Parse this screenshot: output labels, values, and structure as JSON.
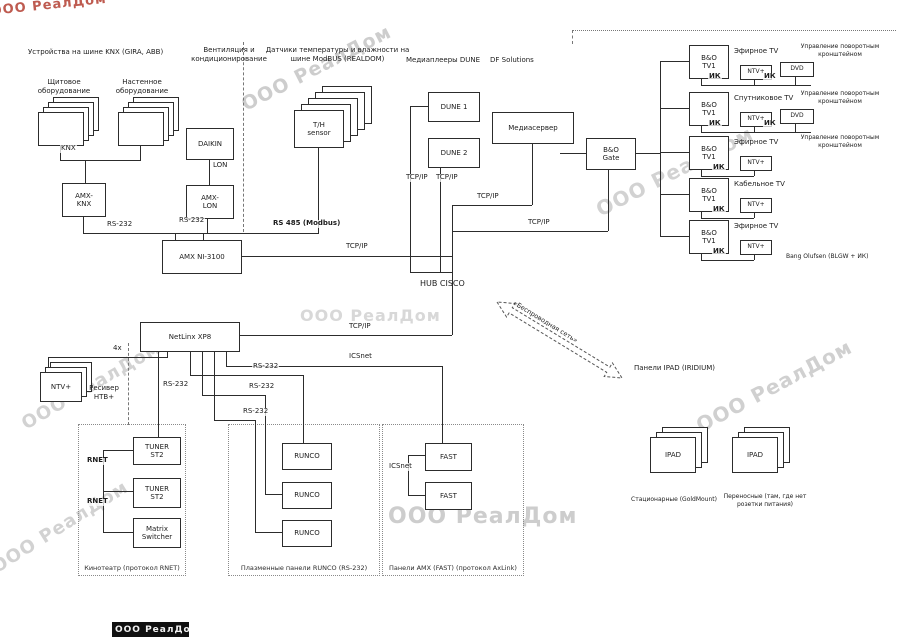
{
  "watermark_text": "ООО РеалДом",
  "footer": {
    "text": "ООО РеалДом"
  },
  "wireless": {
    "label": "«Беспроводная сеть»"
  },
  "diagram": {
    "separators": [
      {
        "x": 243,
        "y": 42,
        "h": 190,
        "kind": "v"
      },
      {
        "x": 128,
        "y": 343,
        "h": 82,
        "kind": "v"
      },
      {
        "x": 572,
        "y": 30,
        "w": 324,
        "kind": "h"
      },
      {
        "x": 572,
        "y": 30,
        "h": 14,
        "kind": "v"
      }
    ],
    "watermarks": [
      {
        "x": -10,
        "y": 4,
        "s": 13,
        "r": -6,
        "c": "#b84a3e",
        "o": 0.9
      },
      {
        "x": 238,
        "y": 96,
        "s": 19,
        "r": -27,
        "c": "#cdcdcd",
        "o": 1
      },
      {
        "x": 592,
        "y": 200,
        "s": 20,
        "r": -27,
        "c": "#d2d2d2",
        "o": 1
      },
      {
        "x": 300,
        "y": 306,
        "s": 16,
        "r": 0,
        "c": "#d8d8d8",
        "o": 1
      },
      {
        "x": 18,
        "y": 416,
        "s": 18,
        "r": -30,
        "c": "#d2d2d2",
        "o": 1
      },
      {
        "x": 692,
        "y": 416,
        "s": 20,
        "r": -28,
        "c": "#d0d0d0",
        "o": 1
      },
      {
        "x": 388,
        "y": 504,
        "s": 22,
        "r": 0,
        "c": "#cdcdcd",
        "o": 1
      },
      {
        "x": -12,
        "y": 560,
        "s": 18,
        "r": -32,
        "c": "#d2d2d2",
        "o": 1
      }
    ],
    "regions": [
      {
        "id": "cinema-zone",
        "x": 78,
        "y": 424,
        "w": 106,
        "h": 150,
        "cap": "Кинотеатр (протокол RNET)"
      },
      {
        "id": "runco-zone",
        "x": 228,
        "y": 424,
        "w": 150,
        "h": 150,
        "cap": "Плазменные панели RUNCO (RS-232)"
      },
      {
        "id": "fast-zone",
        "x": 382,
        "y": 424,
        "w": 140,
        "h": 150,
        "cap": "Панели AMX (FAST) (протокол AxLink)"
      }
    ],
    "stacks": [
      {
        "id": "knx-stack-shield",
        "x": 38,
        "y": 112,
        "w": 44,
        "h": 32,
        "n": 4,
        "dx": 5,
        "dy": -5,
        "t": ""
      },
      {
        "id": "knx-stack-wall",
        "x": 118,
        "y": 112,
        "w": 44,
        "h": 32,
        "n": 4,
        "dx": 5,
        "dy": -5,
        "t": ""
      },
      {
        "id": "th-sensor-stack",
        "x": 294,
        "y": 110,
        "w": 48,
        "h": 36,
        "n": 5,
        "dx": 7,
        "dy": -6,
        "t": "T/H\nsensor"
      },
      {
        "id": "ntv-receiver-stack",
        "x": 40,
        "y": 372,
        "w": 40,
        "h": 28,
        "n": 3,
        "dx": 5,
        "dy": -5,
        "t": "NTV+"
      },
      {
        "id": "ipad-stack-stationary",
        "x": 650,
        "y": 437,
        "w": 44,
        "h": 34,
        "n": 3,
        "dx": 6,
        "dy": -5,
        "t": "IPAD"
      },
      {
        "id": "ipad-stack-portable",
        "x": 732,
        "y": 437,
        "w": 44,
        "h": 34,
        "n": 3,
        "dx": 6,
        "dy": -5,
        "t": "IPAD"
      }
    ],
    "boxes": [
      {
        "id": "amx-knx",
        "x": 62,
        "y": 183,
        "w": 42,
        "h": 32,
        "t": "AMX-\nKNX"
      },
      {
        "id": "daikin",
        "x": 186,
        "y": 128,
        "w": 46,
        "h": 30,
        "t": "DAIKIN"
      },
      {
        "id": "amx-lon",
        "x": 186,
        "y": 185,
        "w": 46,
        "h": 32,
        "t": "AMX-\nLON"
      },
      {
        "id": "amx-ni-3100",
        "x": 162,
        "y": 240,
        "w": 78,
        "h": 32,
        "t": "AMX NI-3100"
      },
      {
        "id": "dune-1",
        "x": 428,
        "y": 92,
        "w": 50,
        "h": 28,
        "t": "DUNE 1"
      },
      {
        "id": "dune-2",
        "x": 428,
        "y": 138,
        "w": 50,
        "h": 28,
        "t": "DUNE 2"
      },
      {
        "id": "media-server",
        "x": 492,
        "y": 112,
        "w": 80,
        "h": 30,
        "t": "Медиасервер"
      },
      {
        "id": "bo-gate",
        "x": 586,
        "y": 138,
        "w": 48,
        "h": 30,
        "t": "B&O\nGate"
      },
      {
        "id": "netlinx-xp8",
        "x": 140,
        "y": 322,
        "w": 98,
        "h": 28,
        "t": "NetLinx XP8"
      },
      {
        "id": "bo-tv-1",
        "x": 689,
        "y": 45,
        "w": 38,
        "h": 32,
        "t": "B&O\nTV1"
      },
      {
        "id": "bo-tv-2",
        "x": 689,
        "y": 92,
        "w": 38,
        "h": 32,
        "t": "B&O\nTV1"
      },
      {
        "id": "bo-tv-3",
        "x": 689,
        "y": 136,
        "w": 38,
        "h": 32,
        "t": "B&O\nTV1"
      },
      {
        "id": "bo-tv-4",
        "x": 689,
        "y": 178,
        "w": 38,
        "h": 32,
        "t": "B&O\nTV1"
      },
      {
        "id": "bo-tv-5",
        "x": 689,
        "y": 220,
        "w": 38,
        "h": 32,
        "t": "B&O\nTV1"
      },
      {
        "id": "ntv-row1",
        "x": 740,
        "y": 65,
        "w": 30,
        "h": 13,
        "t": "NTV+",
        "s": 6
      },
      {
        "id": "dvd-row1",
        "x": 780,
        "y": 62,
        "w": 32,
        "h": 13,
        "t": "DVD",
        "s": 6
      },
      {
        "id": "ntv-row2",
        "x": 740,
        "y": 112,
        "w": 30,
        "h": 13,
        "t": "NTV+",
        "s": 6
      },
      {
        "id": "dvd-row2",
        "x": 780,
        "y": 109,
        "w": 32,
        "h": 13,
        "t": "DVD",
        "s": 6
      },
      {
        "id": "ntv-row3",
        "x": 740,
        "y": 156,
        "w": 30,
        "h": 13,
        "t": "NTV+",
        "s": 6
      },
      {
        "id": "ntv-row4",
        "x": 740,
        "y": 198,
        "w": 30,
        "h": 13,
        "t": "NTV+",
        "s": 6
      },
      {
        "id": "ntv-row5",
        "x": 740,
        "y": 240,
        "w": 30,
        "h": 13,
        "t": "NTV+",
        "s": 6
      },
      {
        "id": "tuner-st2-1",
        "x": 133,
        "y": 437,
        "w": 46,
        "h": 26,
        "t": "TUNER\nST2"
      },
      {
        "id": "tuner-st2-2",
        "x": 133,
        "y": 478,
        "w": 46,
        "h": 28,
        "t": "TUNER\nST2"
      },
      {
        "id": "matrix-switcher",
        "x": 133,
        "y": 518,
        "w": 46,
        "h": 28,
        "t": "Matrix\nSwitcher"
      },
      {
        "id": "runco-1",
        "x": 282,
        "y": 443,
        "w": 48,
        "h": 25,
        "t": "RUNCO"
      },
      {
        "id": "runco-2",
        "x": 282,
        "y": 482,
        "w": 48,
        "h": 25,
        "t": "RUNCO"
      },
      {
        "id": "runco-3",
        "x": 282,
        "y": 520,
        "w": 48,
        "h": 25,
        "t": "RUNCO"
      },
      {
        "id": "fast-1",
        "x": 425,
        "y": 443,
        "w": 45,
        "h": 26,
        "t": "FAST"
      },
      {
        "id": "fast-2",
        "x": 425,
        "y": 482,
        "w": 45,
        "h": 26,
        "t": "FAST"
      }
    ],
    "wires": [
      [
        60,
        144,
        1,
        16
      ],
      [
        140,
        144,
        1,
        16
      ],
      [
        60,
        160,
        81,
        1
      ],
      [
        85,
        160,
        1,
        23
      ],
      [
        83,
        215,
        1,
        18
      ],
      [
        83,
        233,
        236,
        1
      ],
      [
        175,
        233,
        1,
        7
      ],
      [
        203,
        233,
        1,
        7
      ],
      [
        209,
        158,
        1,
        27
      ],
      [
        207,
        217,
        1,
        16
      ],
      [
        318,
        146,
        1,
        87
      ],
      [
        238,
        256,
        215,
        1
      ],
      [
        452,
        205,
        1,
        130
      ],
      [
        410,
        106,
        18,
        1
      ],
      [
        410,
        106,
        1,
        166
      ],
      [
        440,
        166,
        1,
        106
      ],
      [
        410,
        272,
        42,
        1
      ],
      [
        532,
        142,
        1,
        63
      ],
      [
        452,
        205,
        80,
        1
      ],
      [
        608,
        168,
        1,
        63
      ],
      [
        452,
        231,
        156,
        1
      ],
      [
        560,
        153,
        26,
        1
      ],
      [
        634,
        153,
        26,
        1
      ],
      [
        660,
        61,
        1,
        175
      ],
      [
        660,
        61,
        29,
        1
      ],
      [
        660,
        108,
        29,
        1
      ],
      [
        660,
        152,
        29,
        1
      ],
      [
        660,
        194,
        29,
        1
      ],
      [
        660,
        236,
        29,
        1
      ],
      [
        238,
        335,
        214,
        1
      ],
      [
        701,
        77,
        1,
        8
      ],
      [
        701,
        85,
        110,
        1
      ],
      [
        754,
        78,
        1,
        7
      ],
      [
        795,
        75,
        1,
        10
      ],
      [
        701,
        124,
        1,
        8
      ],
      [
        701,
        132,
        110,
        1
      ],
      [
        754,
        125,
        1,
        7
      ],
      [
        795,
        122,
        1,
        10
      ],
      [
        701,
        168,
        1,
        8
      ],
      [
        701,
        176,
        53,
        1
      ],
      [
        754,
        169,
        1,
        7
      ],
      [
        701,
        210,
        1,
        8
      ],
      [
        701,
        218,
        53,
        1
      ],
      [
        754,
        211,
        1,
        7
      ],
      [
        701,
        252,
        1,
        8
      ],
      [
        701,
        260,
        53,
        1
      ],
      [
        754,
        253,
        1,
        7
      ],
      [
        48,
        357,
        120,
        1
      ],
      [
        167,
        350,
        1,
        7
      ],
      [
        48,
        357,
        1,
        15
      ],
      [
        158,
        350,
        1,
        87
      ],
      [
        190,
        350,
        1,
        25
      ],
      [
        190,
        375,
        113,
        1
      ],
      [
        303,
        375,
        1,
        68
      ],
      [
        202,
        350,
        1,
        45
      ],
      [
        202,
        395,
        63,
        1
      ],
      [
        265,
        395,
        1,
        99
      ],
      [
        265,
        494,
        17,
        1
      ],
      [
        214,
        350,
        1,
        70
      ],
      [
        214,
        420,
        41,
        1
      ],
      [
        255,
        420,
        1,
        112
      ],
      [
        255,
        532,
        27,
        1
      ],
      [
        226,
        350,
        1,
        16
      ],
      [
        226,
        366,
        216,
        1
      ],
      [
        442,
        366,
        1,
        77
      ],
      [
        408,
        455,
        17,
        1
      ],
      [
        408,
        455,
        1,
        40
      ],
      [
        408,
        495,
        17,
        1
      ],
      [
        103,
        450,
        30,
        1
      ],
      [
        103,
        450,
        1,
        82
      ],
      [
        103,
        491,
        30,
        1
      ],
      [
        103,
        532,
        30,
        1
      ]
    ],
    "wire_labels": [
      {
        "x": 60,
        "y": 149,
        "t": "KNX"
      },
      {
        "x": 106,
        "y": 225,
        "t": "RS-232"
      },
      {
        "x": 178,
        "y": 221,
        "t": "RS-232"
      },
      {
        "x": 212,
        "y": 166,
        "t": "LON"
      },
      {
        "x": 272,
        "y": 224,
        "t": "RS 485 (Modbus)",
        "b": 1
      },
      {
        "x": 345,
        "y": 247,
        "t": "TCP/IP"
      },
      {
        "x": 405,
        "y": 178,
        "t": "TCP/IP"
      },
      {
        "x": 435,
        "y": 178,
        "t": "TCP/IP"
      },
      {
        "x": 476,
        "y": 197,
        "t": "TCP/IP"
      },
      {
        "x": 527,
        "y": 223,
        "t": "TCP/IP"
      },
      {
        "x": 348,
        "y": 327,
        "t": "TCP/IP"
      },
      {
        "x": 112,
        "y": 349,
        "t": "4x"
      },
      {
        "x": 162,
        "y": 385,
        "t": "RS-232"
      },
      {
        "x": 252,
        "y": 367,
        "t": "RS-232"
      },
      {
        "x": 248,
        "y": 387,
        "t": "RS-232"
      },
      {
        "x": 242,
        "y": 412,
        "t": "RS-232"
      },
      {
        "x": 348,
        "y": 357,
        "t": "ICSnet"
      },
      {
        "x": 388,
        "y": 467,
        "t": "ICSnet"
      },
      {
        "x": 86,
        "y": 461,
        "t": "RNET",
        "b": 1
      },
      {
        "x": 86,
        "y": 502,
        "t": "RNET",
        "b": 1
      },
      {
        "x": 708,
        "y": 77,
        "t": "ИК",
        "b": 1
      },
      {
        "x": 763,
        "y": 77,
        "t": "ИК",
        "b": 1
      },
      {
        "x": 708,
        "y": 124,
        "t": "ИК",
        "b": 1
      },
      {
        "x": 763,
        "y": 124,
        "t": "ИК",
        "b": 1
      },
      {
        "x": 712,
        "y": 168,
        "t": "ИК",
        "b": 1
      },
      {
        "x": 712,
        "y": 210,
        "t": "ИК",
        "b": 1
      },
      {
        "x": 712,
        "y": 252,
        "t": "ИК",
        "b": 1
      }
    ],
    "texts": [
      {
        "id": "heading-knx",
        "x": 28,
        "y": 48,
        "w": 170,
        "t": "Устройства на шине KNX (GIRA, ABB)",
        "a": "left"
      },
      {
        "id": "caption-shield-equipment",
        "x": 26,
        "y": 78,
        "w": 76,
        "t": "Щитовое\nоборудование",
        "a": "center"
      },
      {
        "id": "caption-wall-equipment",
        "x": 104,
        "y": 78,
        "w": 76,
        "t": "Настенное\nоборудование",
        "a": "center"
      },
      {
        "id": "heading-hvac",
        "x": 186,
        "y": 46,
        "w": 86,
        "t": "Вентиляция и\nкондиционирование",
        "a": "center"
      },
      {
        "id": "heading-sensors",
        "x": 260,
        "y": 46,
        "w": 155,
        "t": "Датчики температуры и влажности на\nшине ModBUS (REALDOM)",
        "a": "center"
      },
      {
        "id": "heading-dune",
        "x": 406,
        "y": 56,
        "w": 95,
        "t": "Медиаплееры DUNE",
        "a": "left"
      },
      {
        "id": "heading-df-solutions",
        "x": 490,
        "y": 56,
        "w": 70,
        "t": "DF Solutions",
        "a": "left"
      },
      {
        "id": "hub-cisco-label",
        "x": 420,
        "y": 279,
        "w": 70,
        "t": "HUB CISCO",
        "a": "left",
        "s": 8
      },
      {
        "id": "caption-ntv-receiver",
        "x": 76,
        "y": 384,
        "w": 56,
        "t": "Ресивер\nНТВ+",
        "a": "center"
      },
      {
        "id": "caption-ipad-title",
        "x": 634,
        "y": 364,
        "w": 120,
        "t": "Панели IPAD (IRIDIUM)",
        "a": "left"
      },
      {
        "id": "caption-ipad-stationary",
        "x": 628,
        "y": 496,
        "w": 92,
        "t": "Стационарные (GoldMount)",
        "a": "center",
        "s": 6
      },
      {
        "id": "caption-ipad-portable",
        "x": 722,
        "y": 493,
        "w": 86,
        "t": "Переносные (там, где нет розетки питания)",
        "a": "center",
        "s": 6
      },
      {
        "id": "tv1-source",
        "x": 734,
        "y": 47,
        "w": 56,
        "t": "Эфирное TV",
        "a": "left"
      },
      {
        "id": "tv1-note",
        "x": 788,
        "y": 43,
        "w": 104,
        "t": "Управление поворотным кронштейном",
        "a": "center",
        "s": 6
      },
      {
        "id": "tv2-source",
        "x": 734,
        "y": 94,
        "w": 60,
        "t": "Спутниковое TV",
        "a": "left"
      },
      {
        "id": "tv2-note",
        "x": 788,
        "y": 90,
        "w": 104,
        "t": "Управление поворотным кронштейном",
        "a": "center",
        "s": 6
      },
      {
        "id": "tv3-source",
        "x": 734,
        "y": 138,
        "w": 56,
        "t": "Эфирное TV",
        "a": "left"
      },
      {
        "id": "tv3-note",
        "x": 788,
        "y": 134,
        "w": 104,
        "t": "Управление поворотным кронштейном",
        "a": "center",
        "s": 6
      },
      {
        "id": "tv4-source",
        "x": 734,
        "y": 180,
        "w": 60,
        "t": "Кабельное TV",
        "a": "left"
      },
      {
        "id": "tv5-source",
        "x": 734,
        "y": 222,
        "w": 56,
        "t": "Эфирное TV",
        "a": "left"
      },
      {
        "id": "bo-protocol-note",
        "x": 786,
        "y": 253,
        "w": 112,
        "t": "Bang Olufsen (BLGW + ИК)",
        "a": "left",
        "s": 6
      }
    ]
  }
}
